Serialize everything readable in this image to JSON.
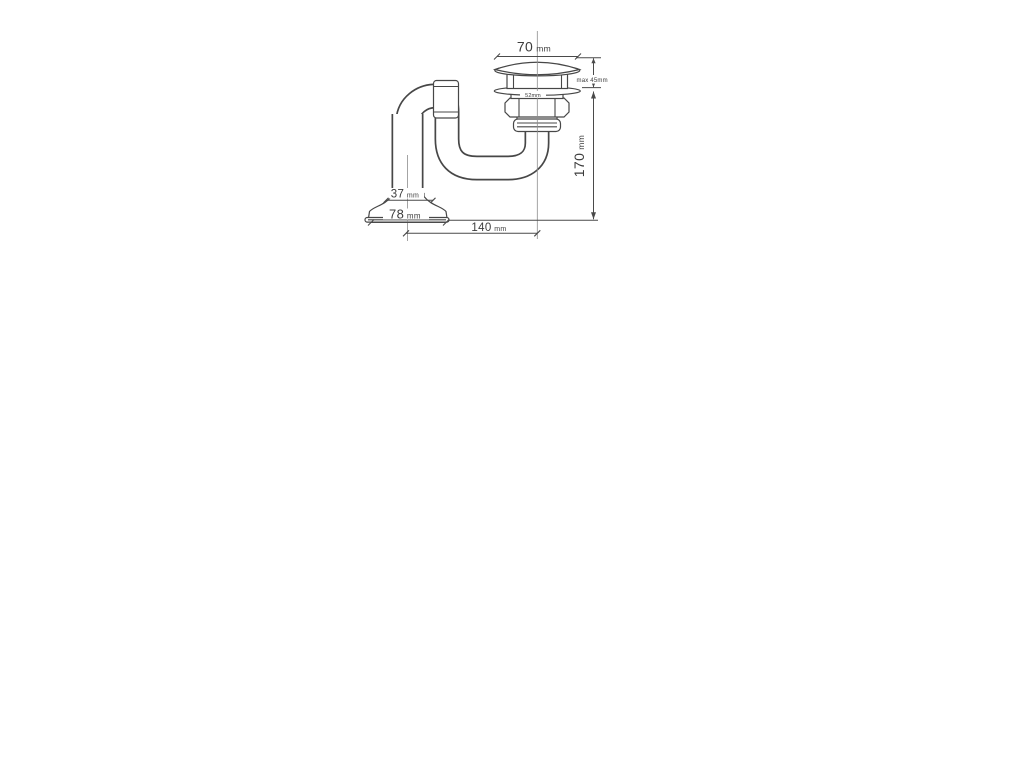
{
  "page": {
    "background": "#ffffff"
  },
  "drawing": {
    "line_color": "#474747",
    "centerline_color": "#8d8d8d",
    "text_color": "#3c3c3c",
    "dimensions": {
      "cap_width": {
        "value": "70",
        "unit": "mm"
      },
      "cap_height_note": {
        "label": "max 45mm"
      },
      "flange_note": {
        "label": "52mm"
      },
      "overall_height": {
        "value": "170",
        "unit": "mm"
      },
      "pipe_width": {
        "value": "37",
        "unit": "mm"
      },
      "base_width": {
        "value": "78",
        "unit": "mm"
      },
      "horizontal_reach": {
        "value": "140",
        "unit": "mm"
      }
    }
  }
}
